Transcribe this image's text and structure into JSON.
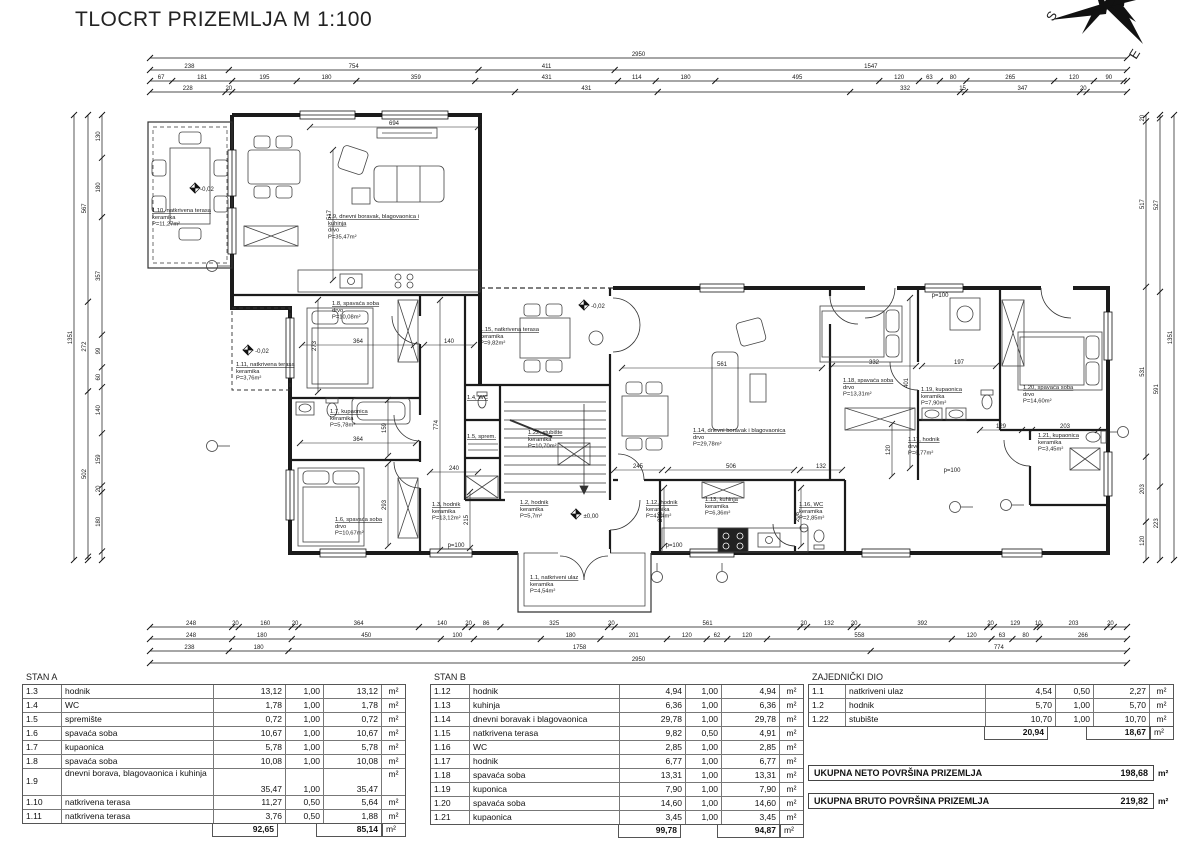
{
  "title": "TLOCRT PRIZEMLJA M 1:100",
  "compass": {
    "s": "S",
    "e": "E"
  },
  "plan": {
    "rooms": [
      {
        "x": 152,
        "y": 212,
        "lines": [
          "1.10, natkrivena terasa",
          "keramika",
          "P=11,27m²"
        ]
      },
      {
        "x": 328,
        "y": 218,
        "u": 2,
        "lines": [
          "1.9, dnevni boravak, blagovaonica i",
          "kuhinja",
          "drvo",
          "P=35,47m²"
        ]
      },
      {
        "x": 332,
        "y": 305,
        "lines": [
          "1.8, spavaća soba",
          "drvo",
          "P=10,08m²"
        ]
      },
      {
        "x": 236,
        "y": 366,
        "lines": [
          "1.11, natkrivena terasa",
          "keramika",
          "P=3,76m²"
        ]
      },
      {
        "x": 330,
        "y": 413,
        "lines": [
          "1.7, kupaonica",
          "keramika",
          "P=5,78m²"
        ]
      },
      {
        "x": 335,
        "y": 521,
        "lines": [
          "1.6, spavaća soba",
          "drvo",
          "P=10,67m²"
        ]
      },
      {
        "x": 432,
        "y": 506,
        "lines": [
          "1.3, hodnik",
          "keramika",
          "P=13,12m²"
        ]
      },
      {
        "x": 467,
        "y": 399,
        "lines": [
          "1.4, WC"
        ]
      },
      {
        "x": 467,
        "y": 438,
        "lines": [
          "1.5, sprem."
        ]
      },
      {
        "x": 480,
        "y": 331,
        "lines": [
          "1.15, natkrivena terasa",
          "keramika",
          "P=9,82m²"
        ]
      },
      {
        "x": 528,
        "y": 434,
        "lines": [
          "1.22, stubište",
          "keramika",
          "P=10,70m²"
        ]
      },
      {
        "x": 520,
        "y": 504,
        "lines": [
          "1.2, hodnik",
          "keramika",
          "P=5,7m²"
        ]
      },
      {
        "x": 646,
        "y": 504,
        "lines": [
          "1.12, hodnik",
          "keramika",
          "P=4,94m²"
        ]
      },
      {
        "x": 530,
        "y": 579,
        "lines": [
          "1.1, natkriveni ulaz",
          "keramika",
          "P=4,54m²"
        ]
      },
      {
        "x": 693,
        "y": 432,
        "lines": [
          "1.14, dnevni boravak i blagovaonica",
          "drvo",
          "P=29,78m²"
        ]
      },
      {
        "x": 705,
        "y": 501,
        "lines": [
          "1.13, kuhinja",
          "keramika",
          "P=6,36m²"
        ]
      },
      {
        "x": 799,
        "y": 506,
        "lines": [
          "1.16, WC",
          "keramika",
          "P=2,85m²"
        ]
      },
      {
        "x": 843,
        "y": 382,
        "lines": [
          "1.18, spavaća soba",
          "drvo",
          "P=13,31m²"
        ]
      },
      {
        "x": 921,
        "y": 391,
        "lines": [
          "1.19, kupaonica",
          "keramika",
          "P=7,90m²"
        ]
      },
      {
        "x": 908,
        "y": 441,
        "lines": [
          "1.17, hodnik",
          "drvo",
          "P=6,77m²"
        ]
      },
      {
        "x": 1023,
        "y": 389,
        "lines": [
          "1.20, spavaća soba",
          "drvo",
          "P=14,60m²"
        ]
      },
      {
        "x": 1038,
        "y": 437,
        "lines": [
          "1.21, kupaonica",
          "keramika",
          "P=3,45m²"
        ]
      }
    ],
    "chains": [
      {
        "d": "h",
        "x": 150,
        "y": 58,
        "len": 977,
        "segs": [
          {
            "w": 2950,
            "t": "2950"
          }
        ]
      },
      {
        "d": "h",
        "x": 150,
        "y": 70,
        "len": 977,
        "segs": [
          {
            "w": 238,
            "t": "238"
          },
          {
            "w": 754,
            "t": "754"
          },
          {
            "w": 411,
            "t": "411"
          },
          {
            "w": 1547,
            "t": "1547"
          }
        ]
      },
      {
        "d": "h",
        "x": 150,
        "y": 81,
        "len": 977,
        "segs": [
          {
            "w": 67,
            "t": "67"
          },
          {
            "w": 181,
            "t": "181"
          },
          {
            "w": 195,
            "t": "195"
          },
          {
            "w": 180,
            "t": "180"
          },
          {
            "w": 359,
            "t": "359"
          },
          {
            "w": 431,
            "t": "431"
          },
          {
            "w": 114,
            "t": "114"
          },
          {
            "w": 180,
            "t": "180"
          },
          {
            "w": 495,
            "t": "495"
          },
          {
            "w": 120,
            "t": "120"
          },
          {
            "w": 63,
            "t": "63"
          },
          {
            "w": 80,
            "t": "80"
          },
          {
            "w": 265,
            "t": "265"
          },
          {
            "w": 120,
            "t": "120"
          },
          {
            "w": 90,
            "t": "90"
          },
          {
            "w": 10,
            "t": ""
          }
        ]
      },
      {
        "d": "h",
        "x": 150,
        "y": 92,
        "len": 977,
        "segs": [
          {
            "w": 228,
            "t": "228"
          },
          {
            "w": 20,
            "t": "20"
          },
          {
            "w": 854,
            "t": ""
          },
          {
            "w": 431,
            "t": "431"
          },
          {
            "w": 581,
            "t": ""
          },
          {
            "w": 332,
            "t": "332"
          },
          {
            "w": 15,
            "t": "15"
          },
          {
            "w": 347,
            "t": "347"
          },
          {
            "w": 20,
            "t": "20"
          },
          {
            "w": 122,
            "t": ""
          }
        ]
      },
      {
        "d": "h",
        "x": 150,
        "y": 627,
        "len": 977,
        "segs": [
          {
            "w": 248,
            "t": "248"
          },
          {
            "w": 20,
            "t": "20"
          },
          {
            "w": 160,
            "t": "160"
          },
          {
            "w": 20,
            "t": "20"
          },
          {
            "w": 364,
            "t": "364"
          },
          {
            "w": 140,
            "t": "140"
          },
          {
            "w": 20,
            "t": "20"
          },
          {
            "w": 86,
            "t": "86"
          },
          {
            "w": 325,
            "t": "325"
          },
          {
            "w": 20,
            "t": "20"
          },
          {
            "w": 561,
            "t": "561"
          },
          {
            "w": 20,
            "t": "20"
          },
          {
            "w": 132,
            "t": "132"
          },
          {
            "w": 20,
            "t": "20"
          },
          {
            "w": 392,
            "t": "392"
          },
          {
            "w": 20,
            "t": "20"
          },
          {
            "w": 129,
            "t": "129"
          },
          {
            "w": 10,
            "t": "10"
          },
          {
            "w": 203,
            "t": "203"
          },
          {
            "w": 20,
            "t": "20"
          },
          {
            "w": 40,
            "t": ""
          }
        ]
      },
      {
        "d": "h",
        "x": 150,
        "y": 639,
        "len": 977,
        "segs": [
          {
            "w": 248,
            "t": "248"
          },
          {
            "w": 180,
            "t": "180"
          },
          {
            "w": 450,
            "t": "450"
          },
          {
            "w": 100,
            "t": "100"
          },
          {
            "w": 202,
            "t": ""
          },
          {
            "w": 180,
            "t": "180"
          },
          {
            "w": 201,
            "t": "201"
          },
          {
            "w": 120,
            "t": "120"
          },
          {
            "w": 62,
            "t": "62"
          },
          {
            "w": 120,
            "t": "120"
          },
          {
            "w": 558,
            "t": "558"
          },
          {
            "w": 120,
            "t": "120"
          },
          {
            "w": 63,
            "t": "63"
          },
          {
            "w": 80,
            "t": "80"
          },
          {
            "w": 266,
            "t": "266"
          }
        ]
      },
      {
        "d": "h",
        "x": 150,
        "y": 651,
        "len": 977,
        "segs": [
          {
            "w": 238,
            "t": "238"
          },
          {
            "w": 180,
            "t": "180"
          },
          {
            "w": 1758,
            "t": "1758"
          },
          {
            "w": 774,
            "t": "774"
          }
        ]
      },
      {
        "d": "h",
        "x": 150,
        "y": 663,
        "len": 977,
        "segs": [
          {
            "w": 2950,
            "t": "2950"
          }
        ]
      },
      {
        "d": "v",
        "x": 74,
        "y": 115,
        "len": 445,
        "segs": [
          {
            "w": 1351,
            "t": "1351"
          }
        ]
      },
      {
        "d": "v",
        "x": 88,
        "y": 115,
        "len": 445,
        "segs": [
          {
            "w": 567,
            "t": "567"
          },
          {
            "w": 272,
            "t": "272"
          },
          {
            "w": 502,
            "t": "502"
          },
          {
            "w": 10,
            "t": ""
          }
        ]
      },
      {
        "d": "v",
        "x": 102,
        "y": 115,
        "len": 445,
        "segs": [
          {
            "w": 130,
            "t": "130"
          },
          {
            "w": 180,
            "t": "180"
          },
          {
            "w": 357,
            "t": "357"
          },
          {
            "w": 99,
            "t": "99"
          },
          {
            "w": 60,
            "t": "60"
          },
          {
            "w": 140,
            "t": "140"
          },
          {
            "w": 159,
            "t": "159"
          },
          {
            "w": 20,
            "t": "20"
          },
          {
            "w": 180,
            "t": "180"
          },
          {
            "w": 26,
            "t": ""
          }
        ]
      },
      {
        "d": "v",
        "x": 1146,
        "y": 115,
        "len": 445,
        "segs": [
          {
            "w": 20,
            "t": "20"
          },
          {
            "w": 517,
            "t": "517"
          },
          {
            "w": 531,
            "t": "531"
          },
          {
            "w": 203,
            "t": "203"
          },
          {
            "w": 120,
            "t": "120"
          }
        ]
      },
      {
        "d": "v",
        "x": 1160,
        "y": 115,
        "len": 445,
        "segs": [
          {
            "w": 10,
            "t": ""
          },
          {
            "w": 527,
            "t": "527"
          },
          {
            "w": 591,
            "t": "591"
          },
          {
            "w": 223,
            "t": "223"
          }
        ]
      },
      {
        "d": "v",
        "x": 1174,
        "y": 115,
        "len": 445,
        "segs": [
          {
            "w": 1351,
            "t": "1351"
          }
        ]
      }
    ],
    "sdims": [
      {
        "d": "h",
        "x": 310,
        "y": 127,
        "len": 168,
        "t": "694"
      },
      {
        "d": "v",
        "x": 333,
        "y": 150,
        "len": 130,
        "t": "517"
      },
      {
        "d": "h",
        "x": 622,
        "y": 368,
        "len": 200,
        "t": "561"
      },
      {
        "d": "h",
        "x": 300,
        "y": 443,
        "len": 116,
        "t": "364"
      },
      {
        "d": "h",
        "x": 302,
        "y": 345,
        "len": 112,
        "t": "364"
      },
      {
        "d": "v",
        "x": 388,
        "y": 400,
        "len": 56,
        "t": "159"
      },
      {
        "d": "v",
        "x": 388,
        "y": 464,
        "len": 82,
        "t": "293"
      },
      {
        "d": "v",
        "x": 318,
        "y": 300,
        "len": 92,
        "t": "273"
      },
      {
        "d": "h",
        "x": 424,
        "y": 345,
        "len": 50,
        "t": "140"
      },
      {
        "d": "v",
        "x": 440,
        "y": 300,
        "len": 250,
        "t": "774"
      },
      {
        "d": "h",
        "x": 832,
        "y": 366,
        "len": 84,
        "t": "332"
      },
      {
        "d": "v",
        "x": 910,
        "y": 298,
        "len": 170,
        "t": "401"
      },
      {
        "d": "h",
        "x": 922,
        "y": 366,
        "len": 74,
        "t": "197"
      },
      {
        "d": "h",
        "x": 980,
        "y": 430,
        "len": 42,
        "t": "129"
      },
      {
        "d": "h",
        "x": 1032,
        "y": 430,
        "len": 66,
        "t": "203"
      },
      {
        "d": "h",
        "x": 614,
        "y": 470,
        "len": 48,
        "t": "245"
      },
      {
        "d": "h",
        "x": 668,
        "y": 470,
        "len": 126,
        "t": "506"
      },
      {
        "d": "h",
        "x": 800,
        "y": 470,
        "len": 42,
        "t": "132"
      },
      {
        "d": "v",
        "x": 664,
        "y": 488,
        "len": 58,
        "t": "208"
      },
      {
        "d": "v",
        "x": 801,
        "y": 488,
        "len": 58,
        "t": "208"
      },
      {
        "d": "v",
        "x": 470,
        "y": 492,
        "len": 56,
        "t": "215"
      },
      {
        "d": "h",
        "x": 430,
        "y": 472,
        "len": 48,
        "t": "240"
      },
      {
        "d": "v",
        "x": 892,
        "y": 424,
        "len": 52,
        "t": "120"
      }
    ],
    "texts": [
      {
        "x": 207,
        "y": 191,
        "t": "-0,02"
      },
      {
        "x": 262,
        "y": 353,
        "t": "-0,02"
      },
      {
        "x": 598,
        "y": 308,
        "t": "-0,02"
      },
      {
        "x": 591,
        "y": 518,
        "t": "±0,00"
      },
      {
        "x": 456,
        "y": 547,
        "t": "p=100"
      },
      {
        "x": 674,
        "y": 547,
        "t": "p=100"
      },
      {
        "x": 940,
        "y": 297,
        "t": "p=100"
      },
      {
        "x": 952,
        "y": 472,
        "t": "p=100"
      }
    ]
  },
  "tables": [
    {
      "title": "STAN A",
      "x": 22,
      "y": 672,
      "rows": [
        {
          "id": "1.3",
          "name": "hodnik",
          "area": "13,12",
          "coef": "1,00",
          "net": "13,12",
          "unit": "m²"
        },
        {
          "id": "1.4",
          "name": "WC",
          "area": "1,78",
          "coef": "1,00",
          "net": "1,78",
          "unit": "m²"
        },
        {
          "id": "1.5",
          "name": "spremište",
          "area": "0,72",
          "coef": "1,00",
          "net": "0,72",
          "unit": "m²"
        },
        {
          "id": "1.6",
          "name": "spavaća soba",
          "area": "10,67",
          "coef": "1,00",
          "net": "10,67",
          "unit": "m²"
        },
        {
          "id": "1.7",
          "name": "kupaonica",
          "area": "5,78",
          "coef": "1,00",
          "net": "5,78",
          "unit": "m²"
        },
        {
          "id": "1.8",
          "name": "spavaća soba",
          "area": "10,08",
          "coef": "1,00",
          "net": "10,08",
          "unit": "m²"
        },
        {
          "id": "1.9",
          "name": "dnevni borava, blagovaonica i kuhinja",
          "area": "35,47",
          "coef": "1,00",
          "net": "35,47",
          "unit": "m²",
          "tall": true
        },
        {
          "id": "1.10",
          "name": "natkrivena terasa",
          "area": "11,27",
          "coef": "0,50",
          "net": "5,64",
          "unit": "m²"
        },
        {
          "id": "1.11",
          "name": "natkrivena terasa",
          "area": "3,76",
          "coef": "0,50",
          "net": "1,88",
          "unit": "m²"
        }
      ],
      "total": {
        "area": "92,65",
        "net": "85,14",
        "unit": "m²"
      }
    },
    {
      "title": "STAN B",
      "x": 430,
      "y": 672,
      "rows": [
        {
          "id": "1.12",
          "name": "hodnik",
          "area": "4,94",
          "coef": "1,00",
          "net": "4,94",
          "unit": "m²"
        },
        {
          "id": "1.13",
          "name": "kuhinja",
          "area": "6,36",
          "coef": "1,00",
          "net": "6,36",
          "unit": "m²"
        },
        {
          "id": "1.14",
          "name": "dnevni boravak i blagovaonica",
          "area": "29,78",
          "coef": "1,00",
          "net": "29,78",
          "unit": "m²"
        },
        {
          "id": "1.15",
          "name": "natkrivena terasa",
          "area": "9,82",
          "coef": "0,50",
          "net": "4,91",
          "unit": "m²"
        },
        {
          "id": "1.16",
          "name": "WC",
          "area": "2,85",
          "coef": "1,00",
          "net": "2,85",
          "unit": "m²"
        },
        {
          "id": "1.17",
          "name": "hodnik",
          "area": "6,77",
          "coef": "1,00",
          "net": "6,77",
          "unit": "m²"
        },
        {
          "id": "1.18",
          "name": "spavaća soba",
          "area": "13,31",
          "coef": "1,00",
          "net": "13,31",
          "unit": "m²"
        },
        {
          "id": "1.19",
          "name": "kuponica",
          "area": "7,90",
          "coef": "1,00",
          "net": "7,90",
          "unit": "m²"
        },
        {
          "id": "1.20",
          "name": "spavaća soba",
          "area": "14,60",
          "coef": "1,00",
          "net": "14,60",
          "unit": "m²"
        },
        {
          "id": "1.21",
          "name": "kupaonica",
          "area": "3,45",
          "coef": "1,00",
          "net": "3,45",
          "unit": "m²"
        }
      ],
      "total": {
        "area": "99,78",
        "net": "94,87",
        "unit": "m²"
      }
    },
    {
      "title": "ZAJEDNIČKI DIO",
      "x": 808,
      "y": 672,
      "rows": [
        {
          "id": "1.1",
          "name": "natkriveni ulaz",
          "area": "4,54",
          "coef": "0,50",
          "net": "2,27",
          "unit": "m²"
        },
        {
          "id": "1.2",
          "name": "hodnik",
          "area": "5,70",
          "coef": "1,00",
          "net": "5,70",
          "unit": "m²"
        },
        {
          "id": "1.22",
          "name": "stubište",
          "area": "10,70",
          "coef": "1,00",
          "net": "10,70",
          "unit": "m²"
        }
      ],
      "total": {
        "area": "20,94",
        "net": "18,67",
        "unit": "m²"
      }
    }
  ],
  "summaries": [
    {
      "label": "UKUPNA NETO POVRŠINA PRIZEMLJA",
      "value": "198,68",
      "unit": "m²"
    },
    {
      "label": "UKUPNA BRUTO POVRŠINA PRIZEMLJA",
      "value": "219,82",
      "unit": "m²"
    }
  ]
}
